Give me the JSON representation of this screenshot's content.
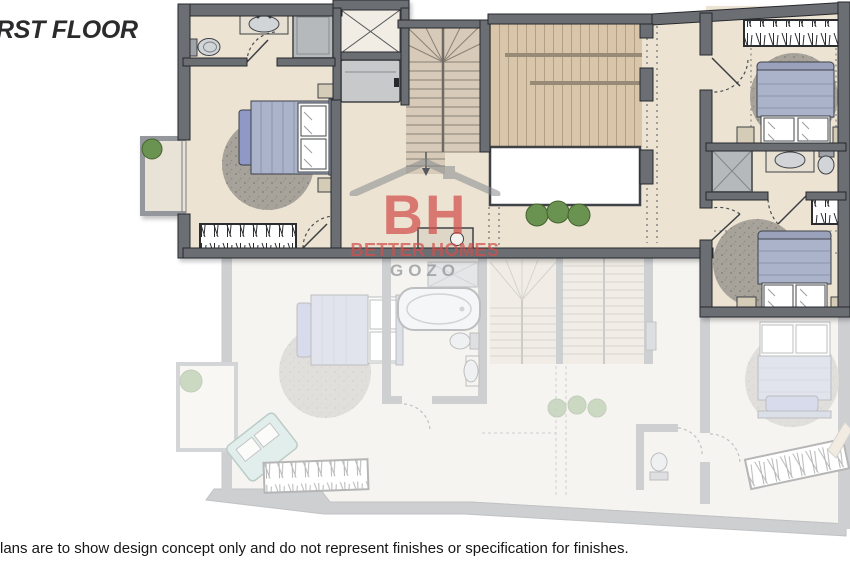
{
  "header": {
    "title": "RST FLOOR"
  },
  "footer": {
    "disclaimer": "lans are to show design concept only and do not represent finishes or specification for finishes."
  },
  "watermark": {
    "initials": "BH",
    "company": "BETTER HOMES",
    "region": "GOZO",
    "accent_red": "#d14f4b",
    "accent_gray": "#8e9397"
  },
  "palette": {
    "wall": "#6b6e73",
    "wall_outline": "#26282c",
    "floor_cream": "#ece3d3",
    "terrace_deck": "#d8c5aa",
    "stair_tread": "#d7cab8",
    "bed_blanket": "#aab3c9",
    "bed_pillow_blue": "#9098c6",
    "rug_gray": "#a7a39b",
    "plant_green": "#6a9351",
    "fixture_gray": "#d2d5d7",
    "shower_gray": "#b6b9bc",
    "lower_floor_opacity": "0.34"
  }
}
